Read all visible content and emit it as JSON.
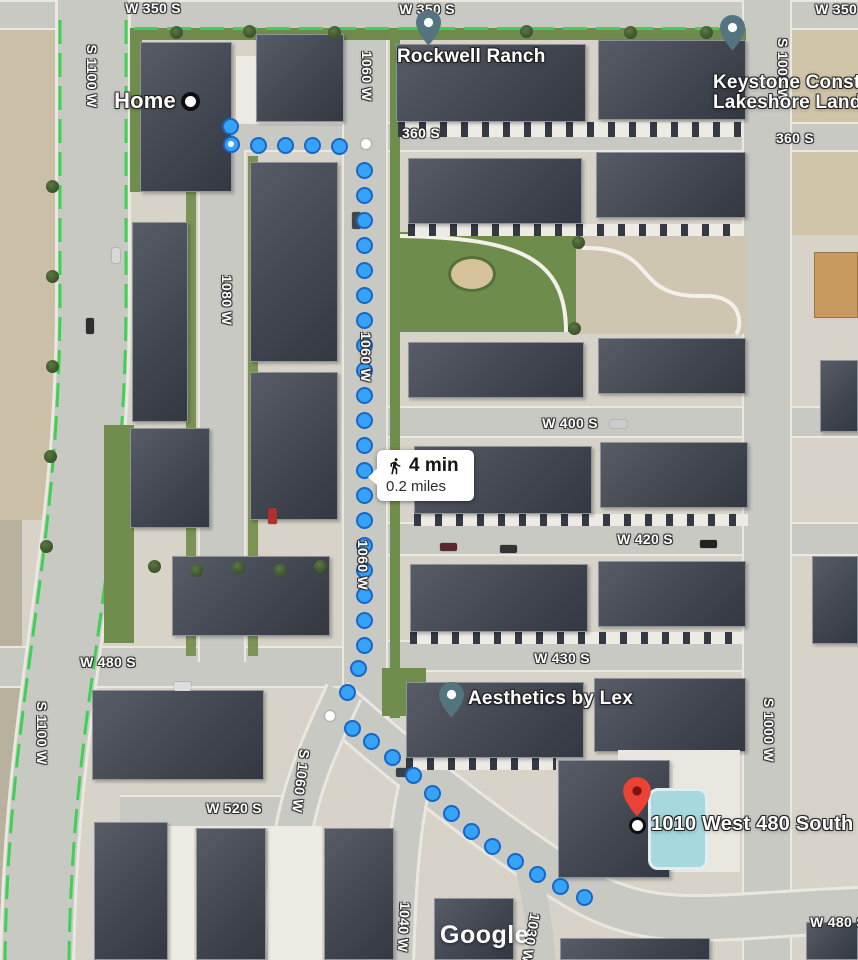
{
  "attribution_logo": "Google",
  "colors": {
    "route_dot": "#36a3f9",
    "route_dot_border": "#1767c8",
    "poi_pin_teal": "#54747f",
    "destination_pin_red": "#ea4335",
    "map_label_text": "#ffffff"
  },
  "route": {
    "mode": "walking",
    "duration": "4 min",
    "distance": "0.2 miles",
    "start_dot": [
      231,
      144
    ],
    "waypoints": [
      [
        366,
        144
      ],
      [
        330,
        716
      ]
    ],
    "dots": [
      [
        230,
        126
      ],
      [
        258,
        145
      ],
      [
        285,
        145
      ],
      [
        312,
        145
      ],
      [
        339,
        146
      ],
      [
        364,
        170
      ],
      [
        364,
        195
      ],
      [
        364,
        220
      ],
      [
        364,
        245
      ],
      [
        364,
        270
      ],
      [
        364,
        295
      ],
      [
        364,
        320
      ],
      [
        364,
        345
      ],
      [
        364,
        370
      ],
      [
        364,
        395
      ],
      [
        364,
        420
      ],
      [
        364,
        445
      ],
      [
        364,
        470
      ],
      [
        364,
        495
      ],
      [
        364,
        520
      ],
      [
        364,
        545
      ],
      [
        364,
        570
      ],
      [
        364,
        595
      ],
      [
        364,
        620
      ],
      [
        364,
        645
      ],
      [
        358,
        668
      ],
      [
        347,
        692
      ],
      [
        352,
        728
      ],
      [
        371,
        741
      ],
      [
        392,
        757
      ],
      [
        413,
        775
      ],
      [
        432,
        793
      ],
      [
        451,
        813
      ],
      [
        471,
        831
      ],
      [
        492,
        846
      ],
      [
        515,
        861
      ],
      [
        537,
        874
      ],
      [
        560,
        886
      ],
      [
        584,
        897
      ]
    ]
  },
  "markers": {
    "home": {
      "label": "Home"
    },
    "rockwell_ranch": {
      "label": "Rockwell Ranch"
    },
    "keystone": {
      "label_line1": "Keystone Construc",
      "label_line2": "Lakeshore Landing"
    },
    "aesthetics": {
      "label": "Aesthetics by Lex"
    },
    "destination": {
      "label": "1010 West 480 South"
    }
  },
  "street_labels": [
    {
      "text": "W 350 S",
      "x": 153,
      "y": 8,
      "rotate": 0
    },
    {
      "text": "W 350 S",
      "x": 427,
      "y": 9,
      "rotate": 0
    },
    {
      "text": "W 350 S",
      "x": 843,
      "y": 9,
      "rotate": 0
    },
    {
      "text": "S 1100 W",
      "x": 92,
      "y": 76,
      "rotate": 90
    },
    {
      "text": "1060 W",
      "x": 367,
      "y": 76,
      "rotate": 90
    },
    {
      "text": "S 1000 W",
      "x": 783,
      "y": 70,
      "rotate": 90
    },
    {
      "text": "360 S",
      "x": 421,
      "y": 133,
      "rotate": 0
    },
    {
      "text": "360 S",
      "x": 795,
      "y": 138,
      "rotate": 0
    },
    {
      "text": "1080 W",
      "x": 227,
      "y": 300,
      "rotate": 90
    },
    {
      "text": "1060 W",
      "x": 366,
      "y": 357,
      "rotate": 90
    },
    {
      "text": "W 400 S",
      "x": 570,
      "y": 423,
      "rotate": 0
    },
    {
      "text": "W 420 S",
      "x": 645,
      "y": 539,
      "rotate": 0
    },
    {
      "text": "1060 W",
      "x": 363,
      "y": 565,
      "rotate": 90
    },
    {
      "text": "W 430 S",
      "x": 562,
      "y": 658,
      "rotate": 0
    },
    {
      "text": "W 480 S",
      "x": 108,
      "y": 662,
      "rotate": 0
    },
    {
      "text": "S 1100 W",
      "x": 42,
      "y": 733,
      "rotate": 90
    },
    {
      "text": "S 1000 W",
      "x": 769,
      "y": 730,
      "rotate": 90
    },
    {
      "text": "S 1060 W",
      "x": 301,
      "y": 781,
      "rotate": 97
    },
    {
      "text": "W 520 S",
      "x": 234,
      "y": 808,
      "rotate": 0
    },
    {
      "text": "1040 W",
      "x": 404,
      "y": 927,
      "rotate": 93
    },
    {
      "text": "1030 W",
      "x": 531,
      "y": 938,
      "rotate": 100
    },
    {
      "text": "W 480 S",
      "x": 838,
      "y": 922,
      "rotate": 0
    }
  ]
}
